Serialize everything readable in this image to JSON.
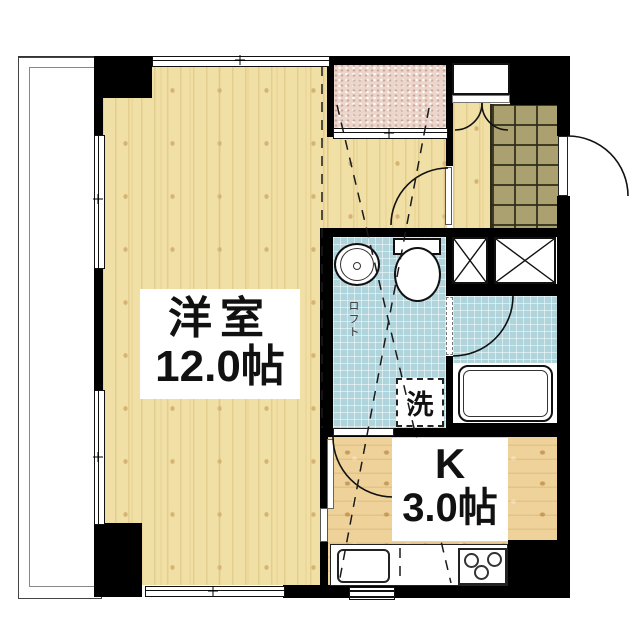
{
  "plan_labels": {
    "main_room": {
      "name": "洋室",
      "area": "12.0帖"
    },
    "kitchen": {
      "name": "K",
      "area": "3.0帖"
    },
    "loft": "ロフト",
    "laundry": "洗"
  },
  "colors": {
    "wall": "#000000",
    "wood_floor": "#f1e0a6",
    "kitchen_floor": "#eed29a",
    "bathroom_floor": "#afd4dc",
    "entrance_tile": "#aba06f",
    "terrace": "#ecd5ca"
  }
}
